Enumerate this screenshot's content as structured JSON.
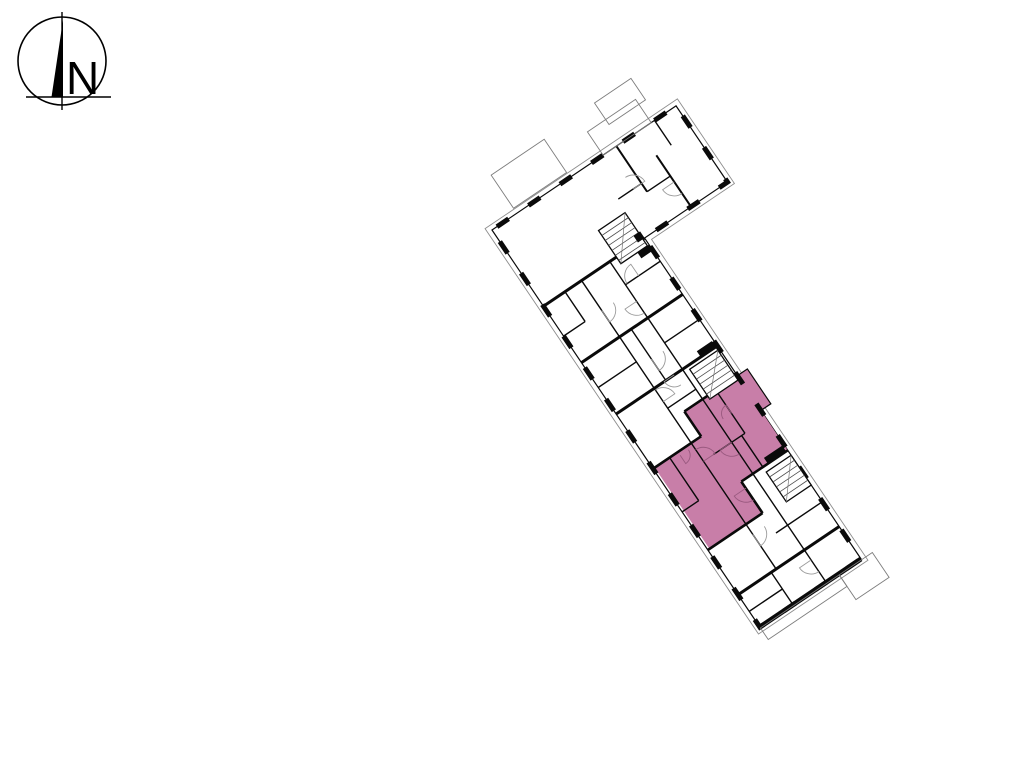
{
  "page": {
    "background_color": "#ffffff"
  },
  "compass": {
    "label": "N"
  },
  "floorplan": {
    "highlight_color": "#c87ea8",
    "wall_color": "#0a0a0a",
    "detail_color": "#9b9b9b"
  }
}
